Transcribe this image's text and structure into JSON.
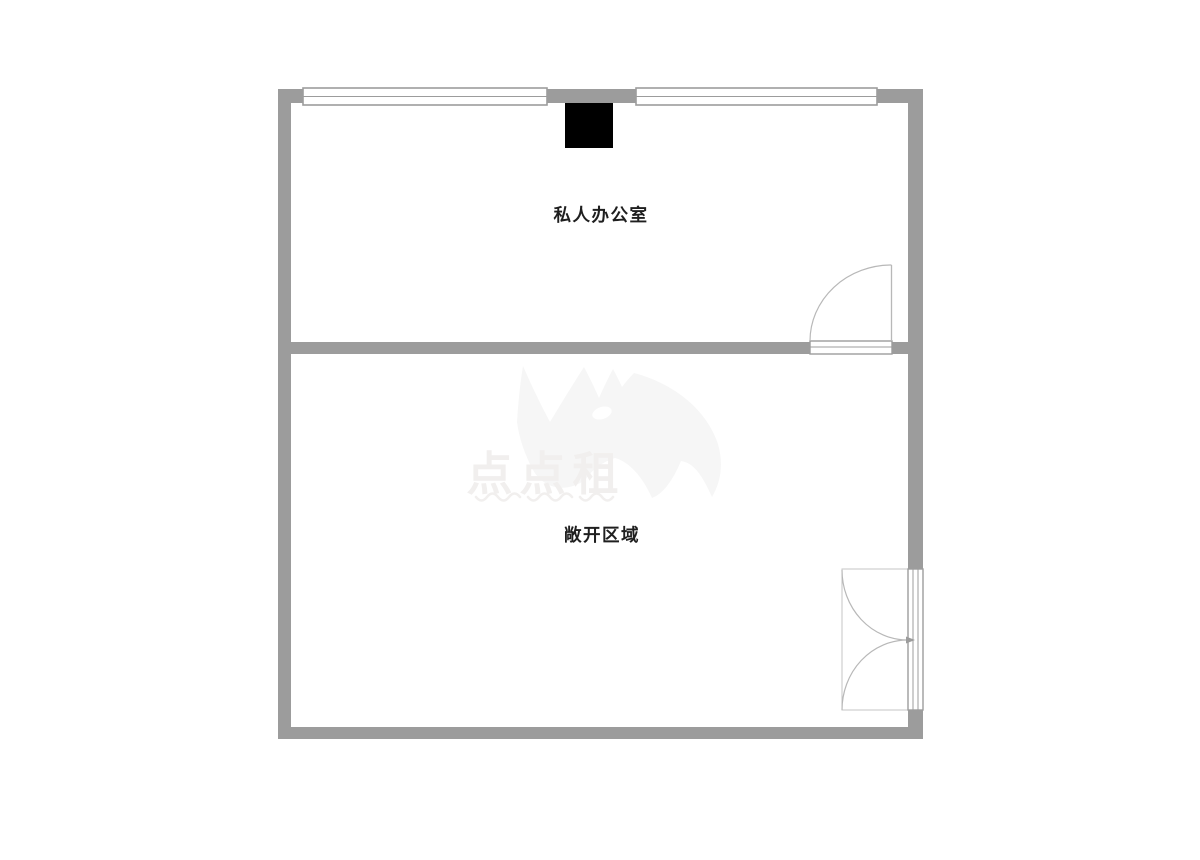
{
  "floorplan": {
    "rooms": [
      {
        "id": "private-office",
        "label": "私人办公室"
      },
      {
        "id": "open-area",
        "label": "敞开区域"
      }
    ],
    "watermark": {
      "brand_text": "点点租",
      "logo": "rhino-logo"
    },
    "features": {
      "column": "structural-column",
      "office_door": "single-swing-door",
      "entrance_door": "double-swing-door",
      "window_count": 2
    },
    "colors": {
      "wall": "#9c9c9c",
      "window_line": "#9c9c9c",
      "door_line": "#b8b8b8",
      "door_box_line": "#c4c4c4",
      "column": "#000000",
      "label_text": "#1f1f1f",
      "watermark_shape": "#f6f6f6",
      "watermark_text": "#f1efee"
    }
  }
}
